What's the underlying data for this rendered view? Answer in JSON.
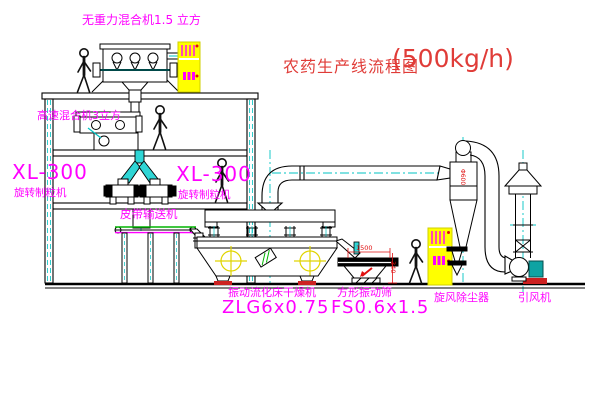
{
  "title": {
    "name": "农药生产线流程图",
    "capacity": "(500kg/h)"
  },
  "labels": {
    "gravity_mixer": "无重力混合机1.5 立方",
    "high_speed_mixer": "高速混合机3立方",
    "granulator_left_model": "XL-300",
    "granulator_left_name": "旋转制粒机",
    "granulator_right_model": "XL-300",
    "granulator_right_name": "旋转制粒机",
    "belt_conveyor": "皮带输送机",
    "dryer_name": "振动流化床干燥机",
    "dryer_model": "ZLG6x0.75",
    "screen_name": "方形振动筛",
    "screen_model": "FS0.6x1.5",
    "cyclone": "旋风除尘器",
    "fan": "引风机"
  },
  "dimensions": {
    "screen_length": "1500",
    "screen_height": "340",
    "cyclone_diameter": "Φ600"
  },
  "colors": {
    "label_magenta": "#ff00ff",
    "title_red": "#e03c38",
    "dimension_red": "#e01010",
    "centerline_cyan": "#00c3c3",
    "chute_cyan": "#2fd5d5",
    "cabinet_yellow": "#ffff00",
    "belt_green": "#00b400",
    "motor_teal": "#0fa3a3",
    "line_black": "#000000"
  }
}
